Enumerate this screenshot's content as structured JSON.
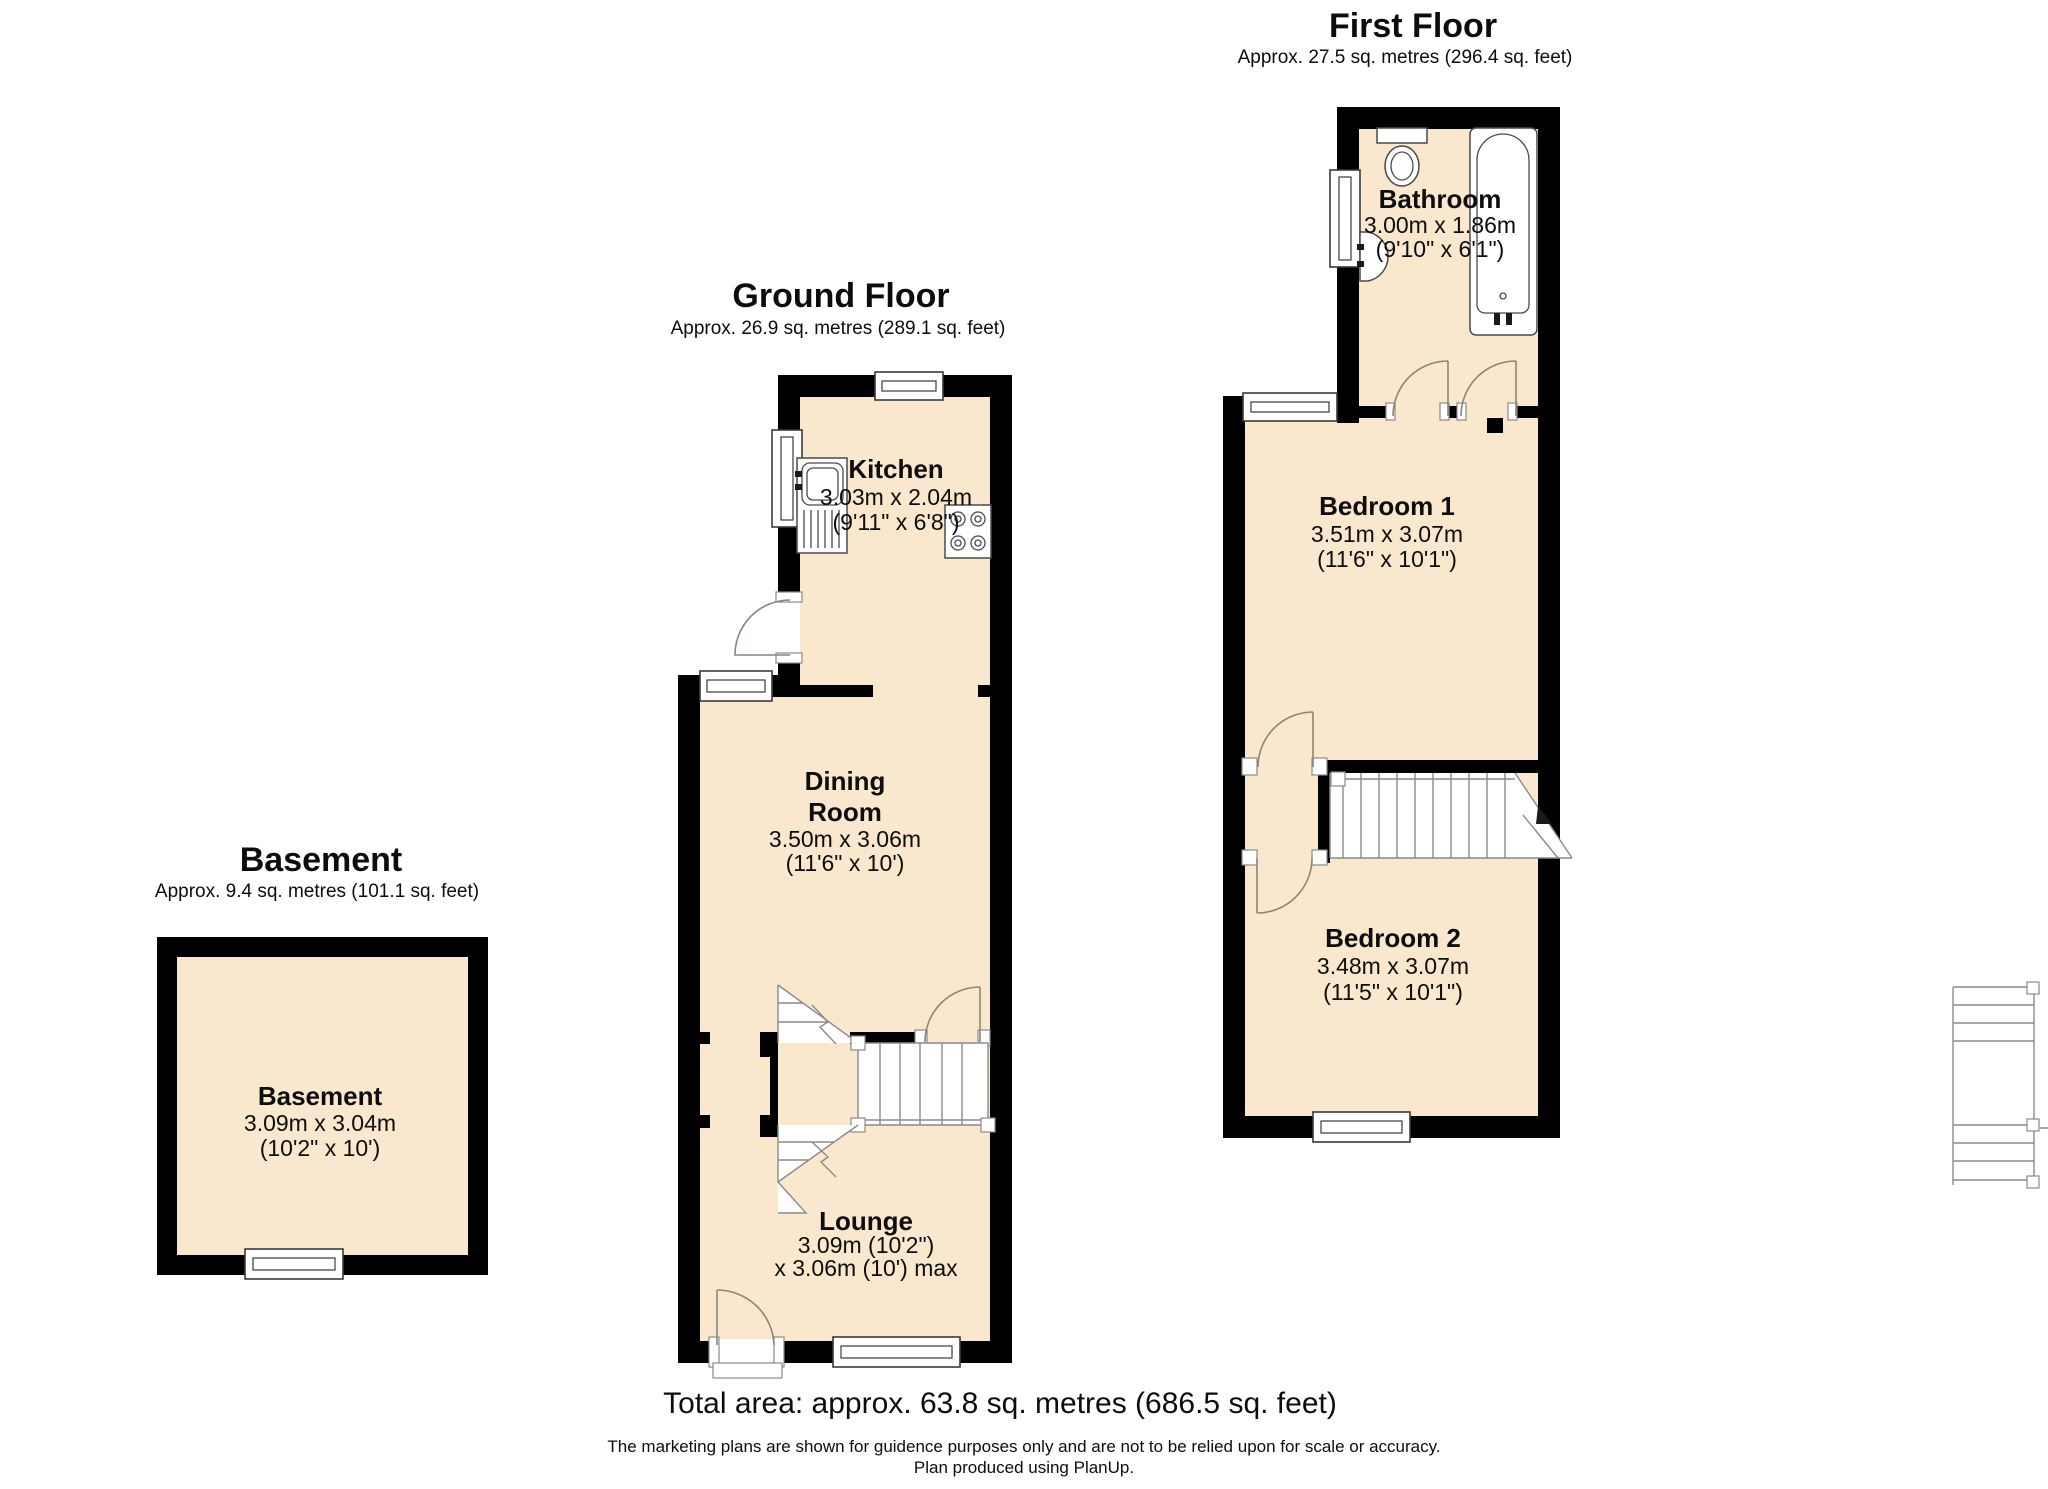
{
  "floors": {
    "first": {
      "title": "First Floor",
      "area": "Approx. 27.5 sq. metres (296.4 sq. feet)"
    },
    "ground": {
      "title": "Ground Floor",
      "area": "Approx. 26.9 sq. metres (289.1 sq. feet)"
    },
    "basement": {
      "title": "Basement",
      "area": "Approx. 9.4 sq. metres (101.1 sq. feet)"
    }
  },
  "rooms": {
    "bathroom": {
      "name": "Bathroom",
      "metric": "3.00m x 1.86m",
      "imperial": "(9'10\" x 6'1\")"
    },
    "bedroom1": {
      "name": "Bedroom 1",
      "metric": "3.51m x 3.07m",
      "imperial": "(11'6\" x 10'1\")"
    },
    "bedroom2": {
      "name": "Bedroom 2",
      "metric": "3.48m x 3.07m",
      "imperial": "(11'5\" x 10'1\")"
    },
    "kitchen": {
      "name": "Kitchen",
      "metric": "3.03m x 2.04m",
      "imperial": "(9'11\" x 6'8\")"
    },
    "dining_room": {
      "name_line1": "Dining",
      "name_line2": "Room",
      "metric": "3.50m x 3.06m",
      "imperial": "(11'6\" x 10')"
    },
    "lounge": {
      "name": "Lounge",
      "metric": "3.09m (10'2\")",
      "imperial": "x 3.06m (10') max"
    },
    "basement_room": {
      "name": "Basement",
      "metric": "3.09m x 3.04m",
      "imperial": "(10'2\" x 10')"
    }
  },
  "footer": {
    "total_area": "Total area: approx. 63.8 sq. metres (686.5 sq. feet)",
    "disclaimer": "The marketing plans are shown for guidence purposes only and are not to be relied upon for scale or accuracy.",
    "produced_by": "Plan produced using PlanUp."
  },
  "colors": {
    "floor_fill": "#f9e8cd",
    "wall": "#000000",
    "door_arc": "#8b8578",
    "stair_line": "#8a8a8a",
    "fixture_line": "#4a4a4a"
  }
}
